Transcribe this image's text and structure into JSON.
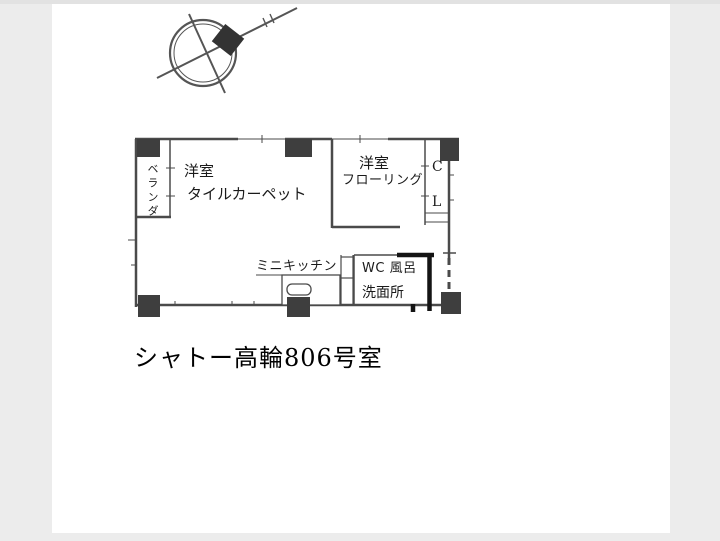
{
  "colors": {
    "page_background": "#ececec",
    "paper": "#ffffff",
    "line": "#4a4a4a",
    "thick_wall": "#141414",
    "pillar": "#3e3e3e",
    "text": "#1a1a1a",
    "caption_text": "#000000",
    "compass": "#555555"
  },
  "floorplan": {
    "caption": "シャトー高輪806号室",
    "labels": {
      "veranda": "ベランダ",
      "main_room_name": "洋室",
      "main_room_floor": "タイルカーペット",
      "second_room_name": "洋室",
      "second_room_floor": "フローリング",
      "closet_top": "C",
      "closet_bottom": "L",
      "kitchen": "ミニキッチン",
      "wc_bath": "WC 風呂",
      "washroom": "洗面所"
    }
  }
}
